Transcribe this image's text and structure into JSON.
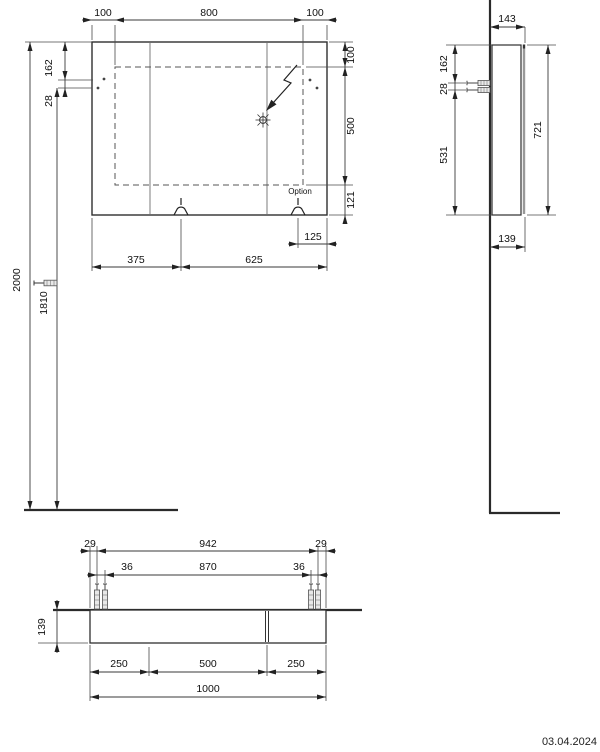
{
  "meta": {
    "date": "03.04.2024"
  },
  "front": {
    "dim_top_left": "100",
    "dim_top_center": "800",
    "dim_top_right": "100",
    "dim_left_offset": "162",
    "dim_left_gap": "28",
    "dim_total_height": "2000",
    "dim_mount_height": "1810",
    "dim_right_top": "100",
    "dim_right_center": "500",
    "dim_right_bottom": "121",
    "dim_option_offset": "125",
    "dim_bottom_left": "375",
    "dim_bottom_right": "625",
    "option_label": "Option"
  },
  "side": {
    "dim_depth_total": "143",
    "dim_screw_offset": "162",
    "dim_screw_gap": "28",
    "dim_lower": "531",
    "dim_height": "721",
    "dim_depth_body": "139"
  },
  "top": {
    "dim_edge_left": "29",
    "dim_outer_span": "942",
    "dim_edge_right": "29",
    "dim_inner_left": "36",
    "dim_inner_span": "870",
    "dim_inner_right": "36",
    "dim_depth": "139",
    "dim_seg_left": "250",
    "dim_seg_center": "500",
    "dim_seg_right": "250",
    "dim_total_width": "1000"
  }
}
